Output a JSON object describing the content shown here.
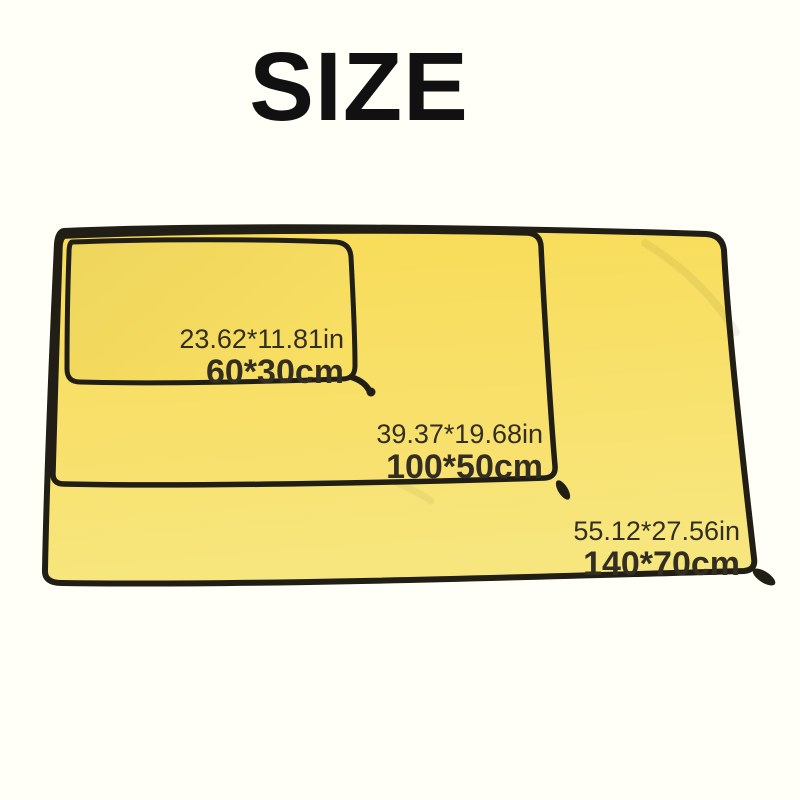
{
  "page": {
    "title": "SIZE"
  },
  "colors": {
    "background": "#fffef7",
    "towel_yellow": "#f9dc57",
    "towel_yellow_light": "#f7e67e",
    "trim_black": "#211e16",
    "label_text": "#332e22",
    "title_text": "#111111"
  },
  "towels": [
    {
      "name": "small towel",
      "size_in": "23.62*11.81in",
      "size_cm": "60*30cm"
    },
    {
      "name": "medium towel",
      "size_in": "39.37*19.68in",
      "size_cm": "100*50cm"
    },
    {
      "name": "large towel",
      "size_in": "55.12*27.56in",
      "size_cm": "140*70cm"
    }
  ]
}
